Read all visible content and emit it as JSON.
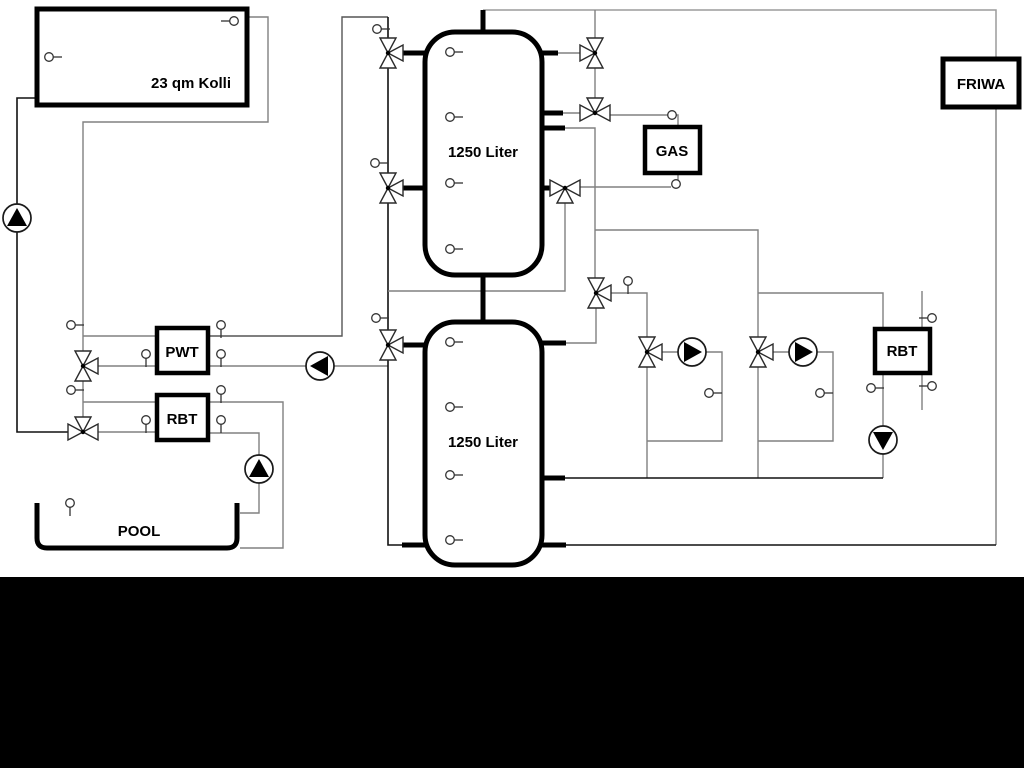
{
  "labels": {
    "collector": "23 qm Kolli",
    "tank_top": "1250 Liter",
    "tank_bottom": "1250 Liter",
    "pwt": "PWT",
    "rbt_left": "RBT",
    "rbt_right": "RBT",
    "gas": "GAS",
    "friwa": "FRIWA",
    "pool": "POOL"
  },
  "colors": {
    "pipe_gray": "#808080",
    "pipe_black": "#111111",
    "component_border": "#000000",
    "background": "#ffffff",
    "bottom_bar": "#000000"
  }
}
